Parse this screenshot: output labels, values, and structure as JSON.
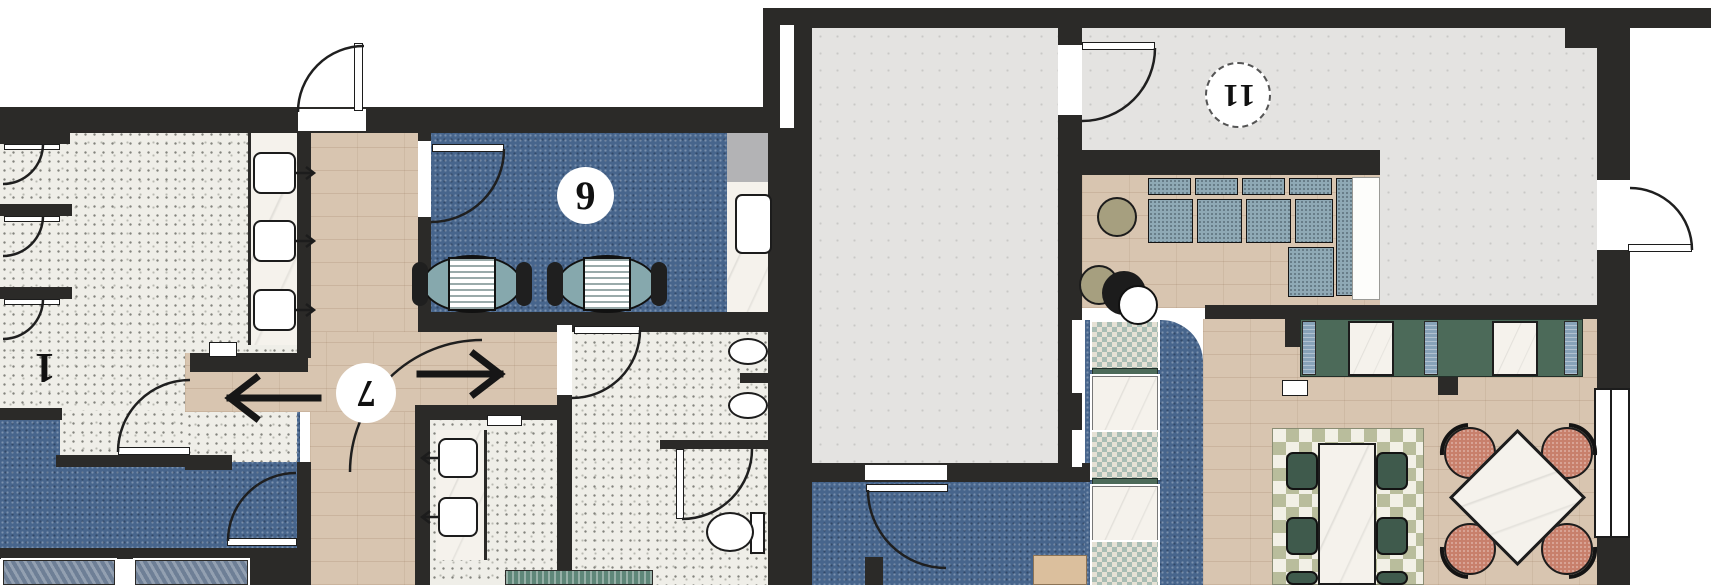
{
  "floor_plan": {
    "title": "interior-floor-plan",
    "unit_labels": [
      {
        "id": "unit-1",
        "text": "1",
        "rotated": true,
        "circle": false
      },
      {
        "id": "unit-7",
        "text": "7",
        "rotated": true,
        "circle": true
      },
      {
        "id": "unit-9",
        "text": "9",
        "rotated": false,
        "circle": true
      },
      {
        "id": "unit-11",
        "text": "11",
        "rotated": true,
        "circle": true,
        "dashed_border": true
      }
    ],
    "direction_arrows": [
      {
        "direction": "left"
      },
      {
        "direction": "right"
      }
    ],
    "colors": {
      "wall": "#2b2a28",
      "carpet_blue": "#47658c",
      "wood_floor": "#d8c5b0",
      "terrazzo": "#efeee8",
      "concrete": "#e4e3e1",
      "marble": "#f5f2ec",
      "sofa_blue": "#8fa9b5",
      "bench_green": "#4c6a59",
      "chair_coral": "#c8806c",
      "ottoman_olive": "#a69f7f",
      "landing_gray": "#b3b3b5"
    },
    "icons": [
      "door-swing-icon",
      "sink-icon",
      "toilet-icon",
      "urinal-icon",
      "bathtub-icon",
      "sofa-icon",
      "ottoman-icon",
      "dining-table-icon",
      "booth-table-icon",
      "direction-arrow-icon",
      "window-icon"
    ]
  }
}
